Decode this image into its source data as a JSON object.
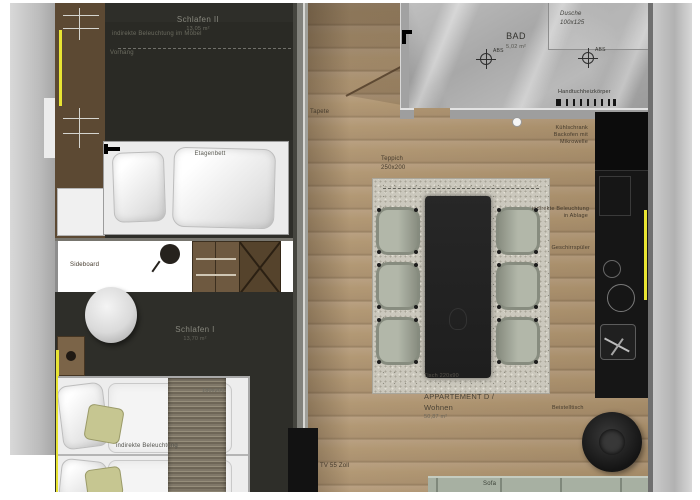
{
  "rooms": {
    "schlafen2": {
      "name": "Schlafen II",
      "area": "13,05 m²"
    },
    "schlafen1": {
      "name": "Schlafen I",
      "area": "13,70 m²"
    },
    "bad": {
      "name": "BAD",
      "area": "5,02 m²"
    },
    "apartment": {
      "line1": "APPARTEMENT D /",
      "line2": "Wohnen",
      "area": "50,87 m²"
    }
  },
  "labels": {
    "etagenbett": "Etagenbett",
    "beleuchtung_moebel": "indirekte Beleuchtung im Möbel",
    "vorhang": "Vorhang",
    "sideboard": "Sideboard",
    "beleuchtung_indirekt": "indirekte Beleuchtung",
    "bett_groesse": "180x200",
    "tapete": "Tapete",
    "teppich1": "Teppich",
    "teppich2": "250x200",
    "tisch": "Tisch 220x90",
    "dusche1": "Dusche",
    "dusche2": "100x125",
    "abs": "ABS",
    "handtuchheizkoerper": "Handtuchheizkörper",
    "kueche1": "Kühlschrank",
    "kueche2": "Backofen mit",
    "kueche3": "Mikrowelle",
    "ablage1": "indirekte Beleuchtung",
    "ablage2": "in Ablage",
    "geschirrspueler": "Geschirrspüler",
    "beistelltisch": "Beistelltisch",
    "tv": "TV 55 Zoll",
    "sofa": "Sofa"
  },
  "colors": {
    "led_accent": "#e8e433",
    "wood": "#b0956f",
    "dark_floor": "#2e2e29"
  }
}
